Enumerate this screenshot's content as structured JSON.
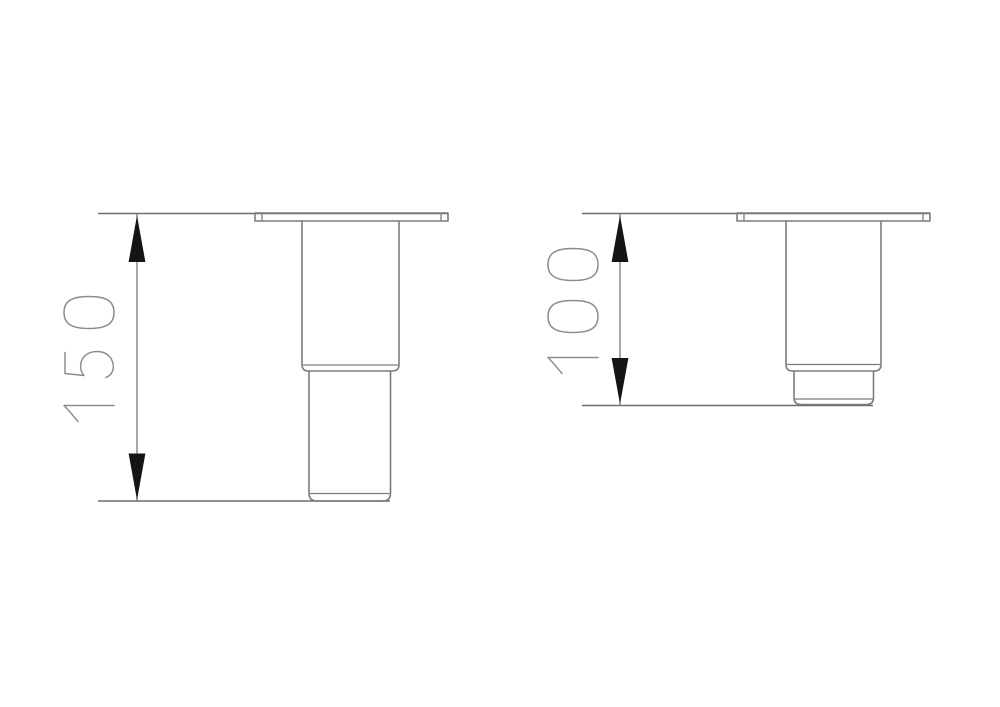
{
  "drawing": {
    "type": "technical-dimension-drawing",
    "background": "#ffffff",
    "colors": {
      "line": "#7c7c7c",
      "dimension": "#6f6f6f",
      "arrow": "#151515",
      "label": "#8d8d8d"
    },
    "views": [
      {
        "id": "leg-150",
        "part": "furniture-leg-side-view",
        "dimension_value": "150",
        "dimension_orientation": "vertical-rotated-90ccw"
      },
      {
        "id": "leg-100",
        "part": "furniture-leg-side-view",
        "dimension_value": "100",
        "dimension_orientation": "vertical-rotated-90ccw"
      }
    ]
  }
}
